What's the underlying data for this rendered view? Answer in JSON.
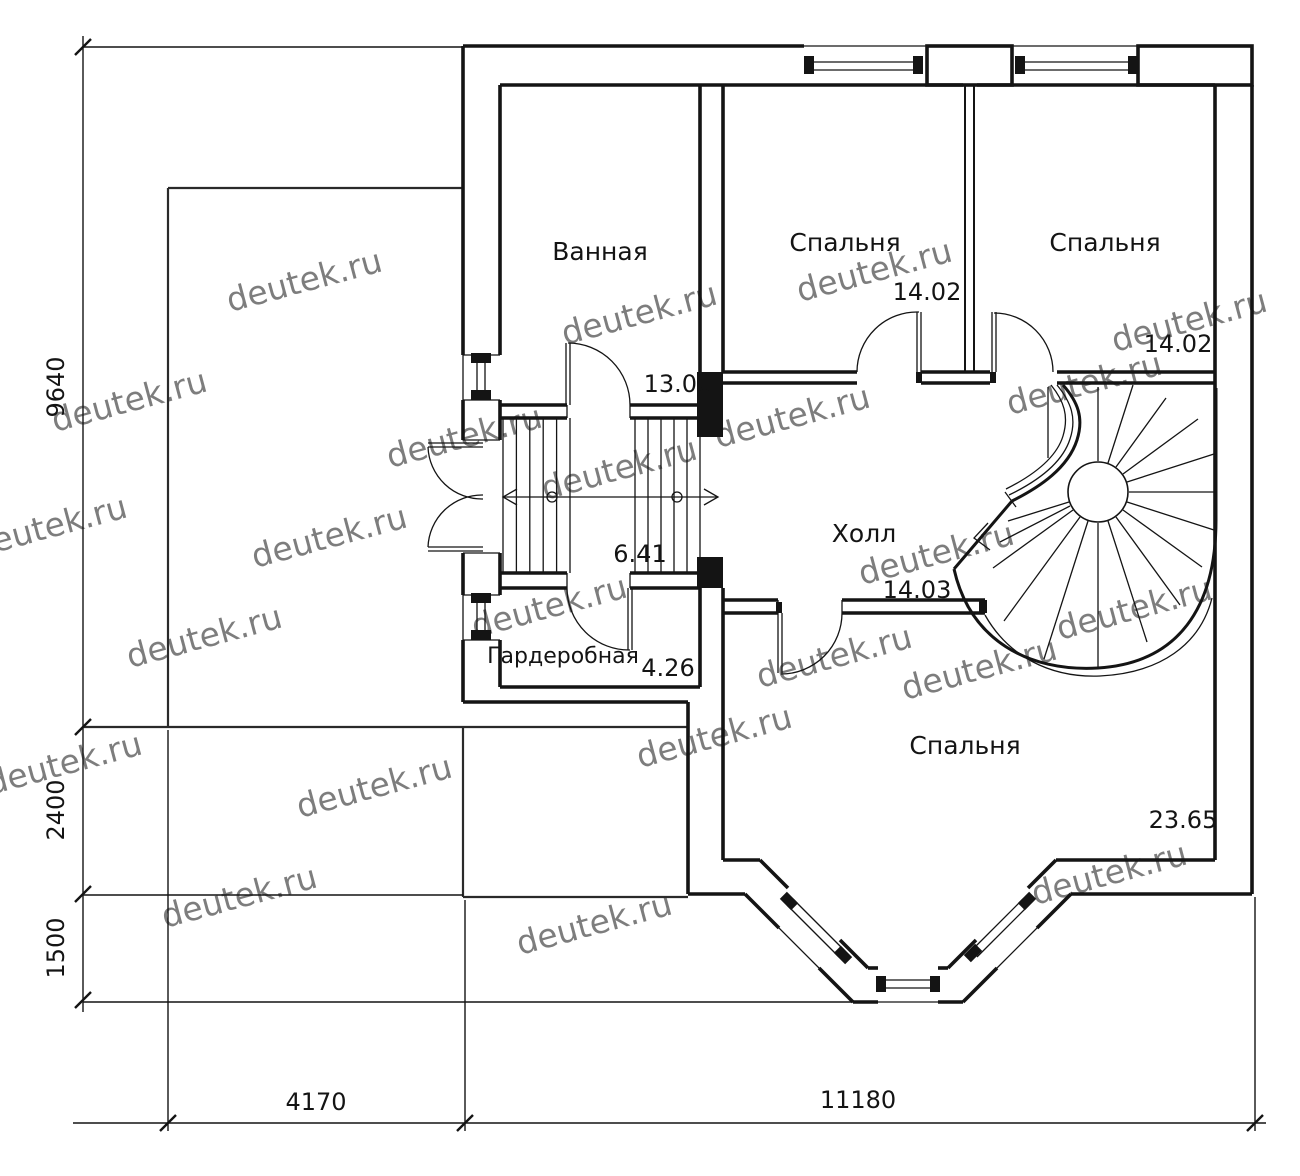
{
  "document": {
    "type": "architectural-floor-plan",
    "language": "ru"
  },
  "watermark": {
    "text": "deutek.ru",
    "color": "#c9c9c9"
  },
  "rooms": [
    {
      "id": "bathroom",
      "name": "Ванная",
      "area": "13.00"
    },
    {
      "id": "bedroom-top-mid",
      "name": "Спальня",
      "area": "14.02"
    },
    {
      "id": "bedroom-top-right",
      "name": "Спальня",
      "area": "14.02"
    },
    {
      "id": "hall",
      "name": "Холл",
      "area": "14.03"
    },
    {
      "id": "staircase",
      "name": "",
      "area": "6.41"
    },
    {
      "id": "wardrobe",
      "name": "Гардеробная",
      "area": "4.26"
    },
    {
      "id": "bedroom-bottom",
      "name": "Спальня",
      "area": "23.65"
    }
  ],
  "dimensions": {
    "left_vertical": [
      "9640",
      "2400",
      "1500"
    ],
    "bottom_horizontal": [
      "4170",
      "11180"
    ]
  },
  "colors": {
    "line": "#141414",
    "watermark": "#c9c9c9",
    "background": "#ffffff"
  }
}
